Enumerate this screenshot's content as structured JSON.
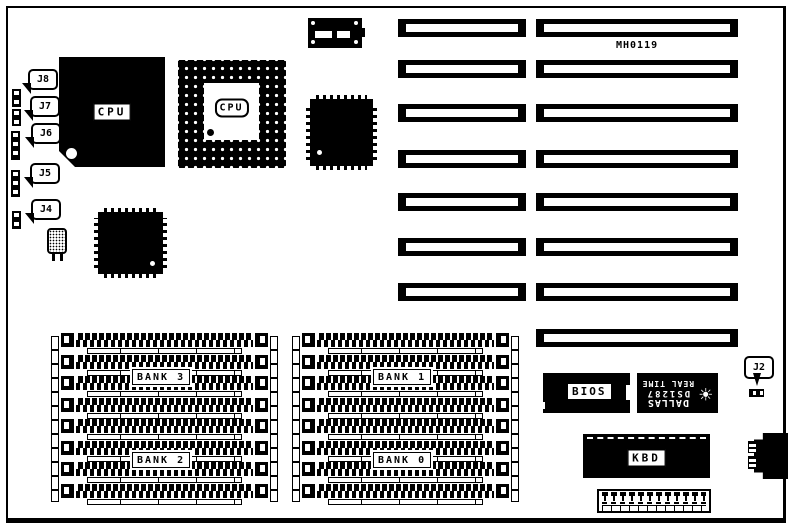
{
  "board": {
    "id_label": "MH0119"
  },
  "cpu_chip": {
    "label": "CPU"
  },
  "cpu_socket": {
    "label": "CPU"
  },
  "jumper_labels": {
    "J8": "J8",
    "J7": "J7",
    "J6": "J6",
    "J5": "J5",
    "J4": "J4",
    "J2": "J2"
  },
  "banks": {
    "bank3": "BANK 3",
    "bank2": "BANK 2",
    "bank1": "BANK 1",
    "bank0": "BANK 0"
  },
  "bios": {
    "label": "BIOS"
  },
  "kbd": {
    "label": "KBD"
  },
  "rtc": {
    "brand": "DALLAS",
    "part": "DS1287",
    "type": "REAL TIME",
    "logo_glyph": "☀"
  },
  "colors": {
    "ink": "#000000",
    "paper": "#ffffff"
  }
}
